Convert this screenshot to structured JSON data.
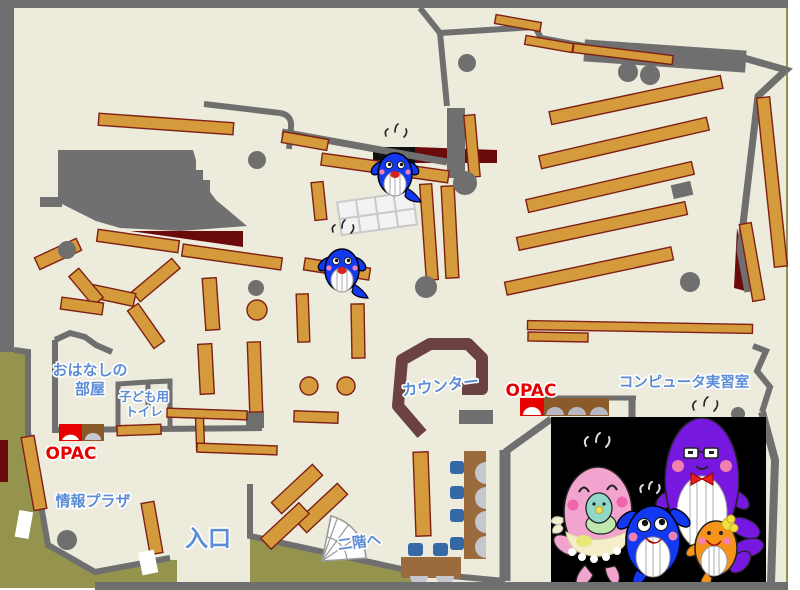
{
  "map": {
    "title": "Library floor map",
    "labels": {
      "storytelling_room_line1": "おはなしの",
      "storytelling_room_line2": "部屋",
      "kids_toilet_line1": "子ども用",
      "kids_toilet_line2": "トイレ",
      "opac_left": "OPAC",
      "info_plaza": "情報プラザ",
      "entrance": "入口",
      "to_second_floor": "二階へ",
      "counter": "カウンター",
      "opac_right": "OPAC",
      "computer_room": "コンピュータ実習室"
    },
    "icons": [
      "whale-mascot-icon",
      "stairs-icon",
      "opac-terminal-icon"
    ],
    "colors": {
      "floor": "#EDEBDB",
      "outside": "#94944E",
      "wall": "#6F6F6F",
      "shelf": "#D49A3C",
      "shelf_edge": "#7E2015",
      "dark_red": "#6B0A0A",
      "counter": "#6B4141",
      "desk": "#996B3D",
      "chair": "#3569A5",
      "label_blue": "#5B8CD6",
      "label_red": "#E60000",
      "photo_background": "#000000",
      "mascot_blue": "#1238F0",
      "mascot_pink": "#F2A3CE",
      "mascot_purple": "#7718E0",
      "mascot_orange": "#F59418"
    }
  }
}
